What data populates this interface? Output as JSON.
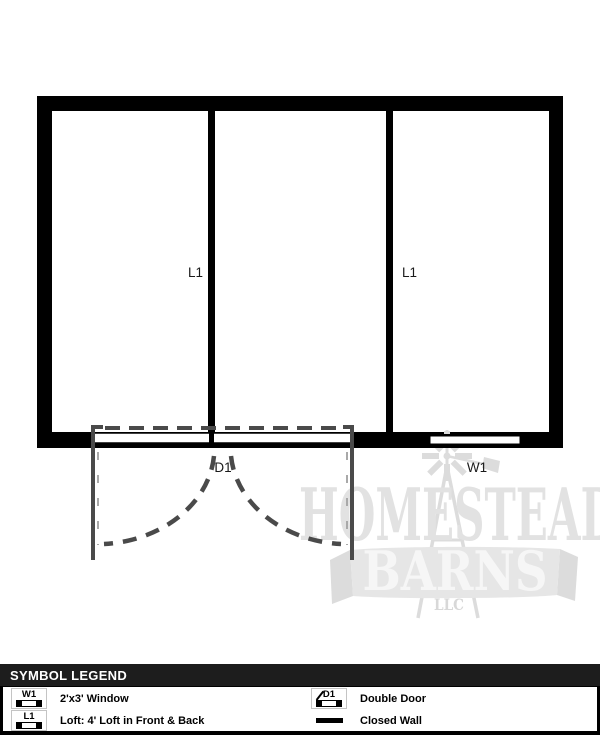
{
  "plan": {
    "labels": {
      "loft_left": "L1",
      "loft_right": "L1",
      "door": "D1",
      "window": "W1"
    }
  },
  "watermark": {
    "word1": "HOMESTEAD",
    "word2": "BARNS",
    "word3": "LLC"
  },
  "legend": {
    "title": "SYMBOL LEGEND",
    "items": [
      {
        "symbol": "W1",
        "label": "2'x3' Window"
      },
      {
        "symbol": "L1",
        "label": "Loft: 4' Loft in Front & Back"
      },
      {
        "symbol": "D1",
        "label": "Double Door"
      },
      {
        "symbol": "",
        "label": "Closed Wall"
      }
    ]
  },
  "colors": {
    "wall": "#000000",
    "door_gray": "#4a4a4a",
    "watermark_gray": "#e3e3e3",
    "legend_header_bg": "#1d1d1d"
  }
}
